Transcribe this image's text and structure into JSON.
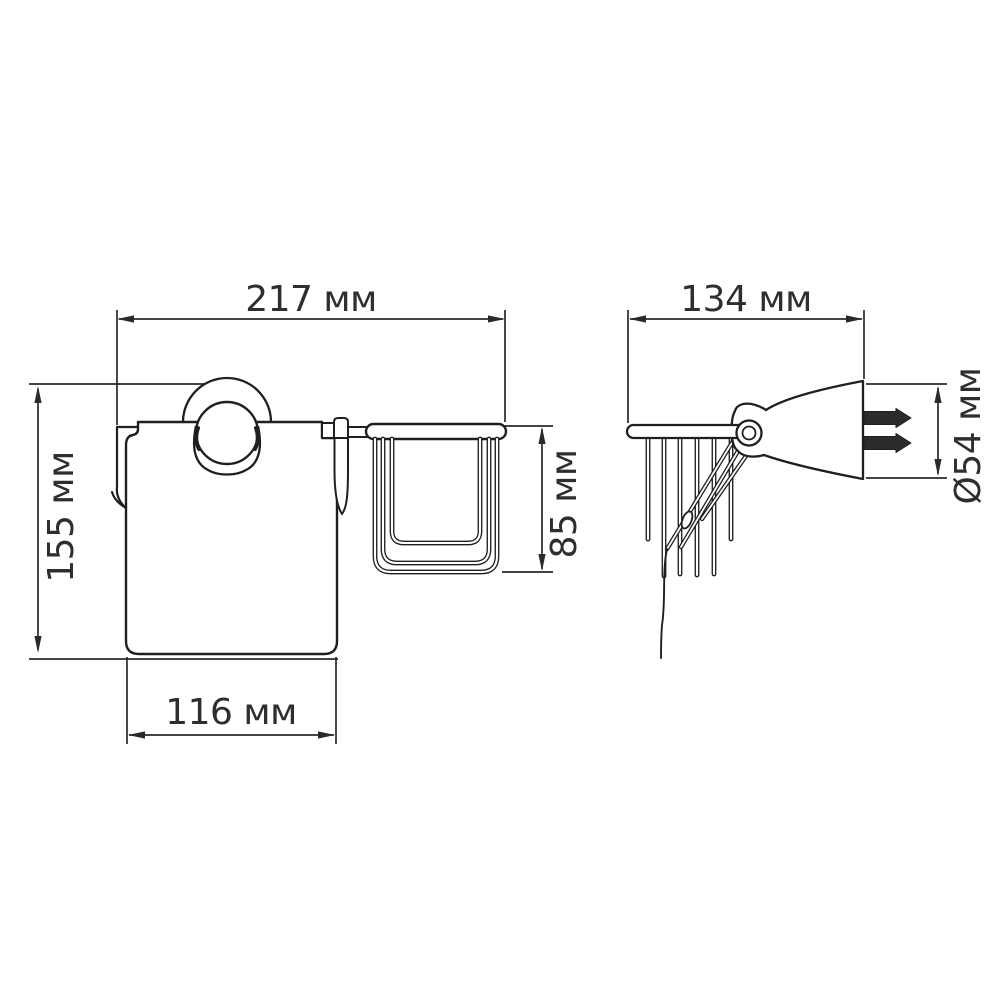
{
  "page": {
    "background": "#ffffff"
  },
  "drawing": {
    "units": "мм",
    "stroke_color": "#1f1f1f",
    "dimension_text_color": "#2e2e2e",
    "dims": {
      "front_width": {
        "label": "217 мм",
        "value": 217
      },
      "front_height": {
        "label": "155 мм",
        "value": 155
      },
      "cover_width": {
        "label": "116 мм",
        "value": 116
      },
      "basket_height": {
        "label": "85 мм",
        "value": 85
      },
      "side_width": {
        "label": "134 мм",
        "value": 134
      },
      "flange_diameter": {
        "label": "Ø54 мм",
        "value": 54
      }
    }
  }
}
